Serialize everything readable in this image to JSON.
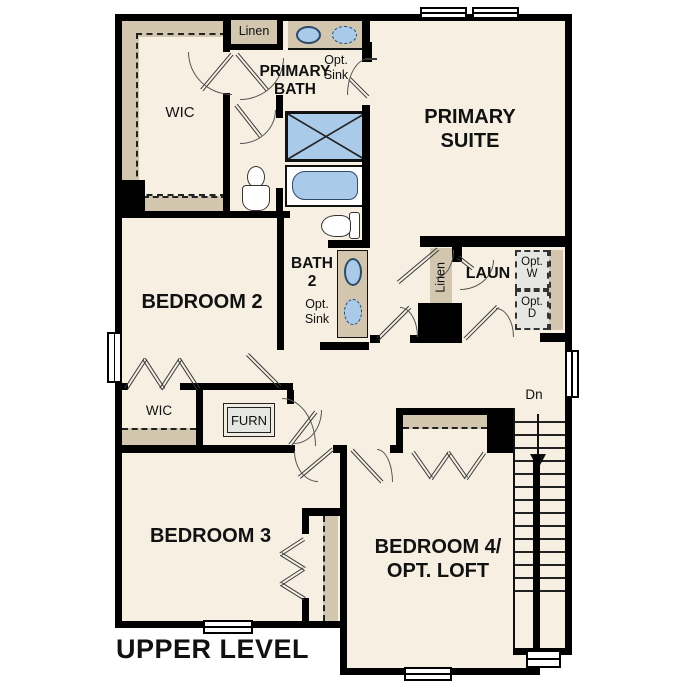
{
  "title": "UPPER LEVEL",
  "rooms": {
    "wic_upper": {
      "label": "WIC"
    },
    "primary_bath": {
      "line1": "PRIMARY",
      "line2": "BATH"
    },
    "primary_suite": {
      "line1": "PRIMARY",
      "line2": "SUITE"
    },
    "bedroom2": {
      "label": "BEDROOM 2"
    },
    "bath2": {
      "line1": "BATH",
      "line2": "2"
    },
    "laundry": {
      "label": "LAUN"
    },
    "wic_lower": {
      "label": "WIC"
    },
    "bedroom3": {
      "label": "BEDROOM 3"
    },
    "bedroom4": {
      "line1": "BEDROOM 4/",
      "line2": "OPT. LOFT"
    }
  },
  "features": {
    "linen_bath": {
      "label": "Linen"
    },
    "linen_laundry": {
      "label": "Linen"
    },
    "furnace": {
      "label": "FURN"
    },
    "opt_sink_primary": {
      "line1": "Opt.",
      "line2": "Sink"
    },
    "opt_sink_bath2": {
      "line1": "Opt.",
      "line2": "Sink"
    },
    "opt_washer": {
      "line1": "Opt.",
      "line2": "W"
    },
    "opt_dryer": {
      "line1": "Opt.",
      "line2": "D"
    },
    "stairs": {
      "direction": "Dn"
    }
  },
  "colors": {
    "background": "#ffffff",
    "floor": "#f7f0e2",
    "wall": "#000000",
    "cabinet_tan": "#d2c6ae",
    "fixture_blue": "#a9cae9",
    "appliance_gray": "#e6e6e2",
    "outline": "#333333"
  }
}
